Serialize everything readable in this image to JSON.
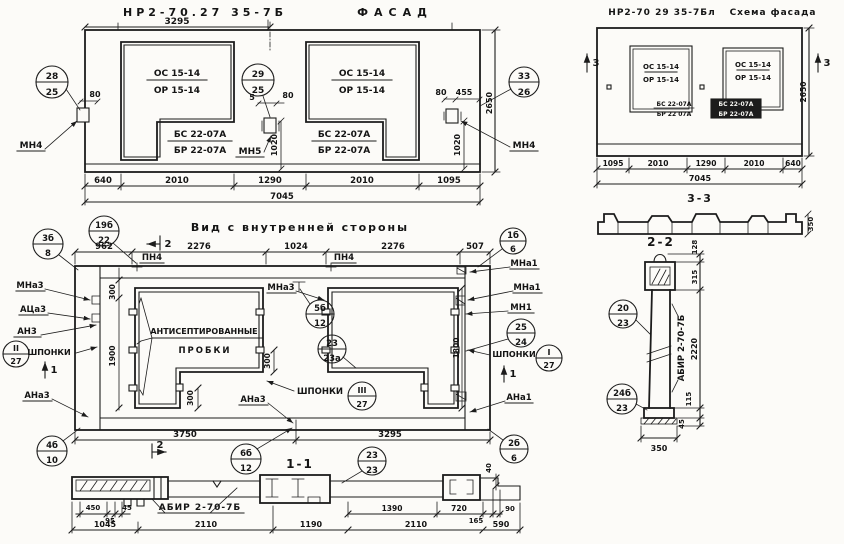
{
  "facade": {
    "title_code": "НР2-70.27 35-7Б",
    "title_name": "ФАСАД",
    "dim_top": "3295",
    "opening_top": "ОС 15-14",
    "opening_bottom": "ОР 15-14",
    "sill_top": "БС 22-07А",
    "sill_bottom": "БР 22-07А",
    "balloon_left": {
      "top": "28",
      "bottom": "25"
    },
    "balloon_mid": {
      "top": "29",
      "bottom": "25"
    },
    "balloon_right": {
      "top": "33",
      "bottom": "26"
    },
    "anchor_left": "МН4",
    "anchor_mid": "МН5",
    "anchor_right": "МН4",
    "dim_80": "80",
    "dim_5": "5",
    "dim_455": "455",
    "dim_1020": "1020",
    "dim_2650": "2650",
    "dims_bottom": [
      "640",
      "2010",
      "1290",
      "2010",
      "1095"
    ],
    "dim_total": "7045"
  },
  "scheme": {
    "title_code": "НР2-70 29 35-7Бл",
    "title_name": "Схема фасада",
    "opening_top": "ОС 15-14",
    "opening_bottom": "ОР 15-14",
    "sill1_top": "БС 22-07А",
    "sill1_bottom": "БР 22 07А",
    "sill2_top": "БС 22-07А",
    "sill2_bottom": "БР 22-07А",
    "marker": "3",
    "dim_2650": "2650",
    "dims_bottom": [
      "1095",
      "2010",
      "1290",
      "2010",
      "640"
    ],
    "dim_total": "7045",
    "section_title": "3-3",
    "dim_350": "350"
  },
  "inner": {
    "title": "Вид с внутренней стороны",
    "dims_top": [
      "962",
      "2276",
      "1024",
      "2276",
      "507"
    ],
    "pn4": "ПН4",
    "note1": "АНТИСЕПТИРОВАННЫЕ",
    "note2": "ПРОБКИ",
    "shponki": "ШПОНКИ",
    "labels": {
      "mna3": "МНа3",
      "aca3": "АЦа3",
      "an3": "АН3",
      "ana3": "АНа3",
      "mna1": "МНа1",
      "mn1": "МН1",
      "ana1": "АНа1"
    },
    "balloons": {
      "b3b8": {
        "top": "3б",
        "bottom": "8"
      },
      "b19b22": {
        "top": "19б",
        "bottom": "22"
      },
      "b1b6": {
        "top": "1б",
        "bottom": "6"
      },
      "b5b12": {
        "top": "5б",
        "bottom": "12"
      },
      "b23a": {
        "top": "23",
        "bottom": "23а"
      },
      "b2524": {
        "top": "25",
        "bottom": "24"
      },
      "bII": {
        "top": "II",
        "bottom": "27"
      },
      "bI": {
        "top": "I",
        "bottom": "27"
      },
      "bIII": {
        "top": "III",
        "bottom": "27"
      },
      "b6b12": {
        "top": "6б",
        "bottom": "12"
      },
      "b4b10": {
        "top": "4б",
        "bottom": "10"
      },
      "b2b6": {
        "top": "2б",
        "bottom": "6"
      },
      "b2323": {
        "top": "23",
        "bottom": "23"
      }
    },
    "dim_300": "300",
    "dim_1900": "1900",
    "dim_1800": "1800",
    "dim_40": "40",
    "dims_bottom": [
      "3750",
      "3295"
    ],
    "marker_1": "1",
    "marker_2": "2"
  },
  "section11": {
    "title": "1-1",
    "label": "АБИР 2-70-7Б",
    "dims_row1_left": [
      "450",
      "95",
      "45"
    ],
    "dims_row1_right": [
      "1390",
      "720",
      "165",
      "90"
    ],
    "dims_row2": [
      "1045",
      "2110",
      "1190",
      "2110",
      "590"
    ]
  },
  "section22": {
    "title": "2-2",
    "label": "АБИР 2-70-7Б",
    "balloon_top": {
      "top": "20",
      "bottom": "23"
    },
    "balloon_bot": {
      "top": "24б",
      "bottom": "23"
    },
    "d128": "128",
    "d315": "315",
    "d2220": "2220",
    "d115": "115",
    "d45": "45",
    "d350": "350"
  }
}
